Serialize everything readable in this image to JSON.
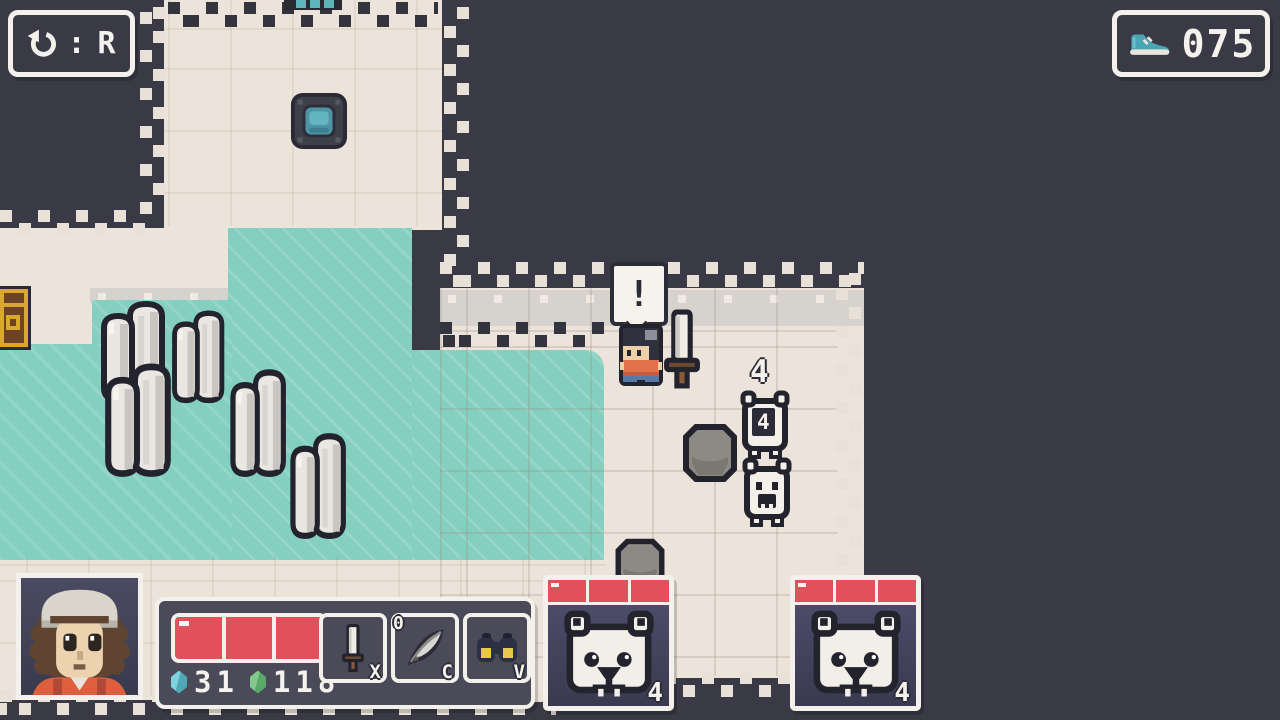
{
  "hud": {
    "undo_button": {
      "icon": "undo-arrow-icon",
      "separator": ":",
      "key": "R"
    },
    "step_counter": {
      "icon": "shoe-icon",
      "value": "075"
    }
  },
  "player": {
    "hp_segments": 3,
    "currencies": [
      {
        "icon": "teal-gem-icon",
        "value": "31",
        "color": "#4fa8b8"
      },
      {
        "icon": "green-gem-icon",
        "value": "118",
        "color": "#5ba968"
      }
    ],
    "slots": [
      {
        "icon": "sword-icon",
        "key": "X"
      },
      {
        "icon": "quill-icon",
        "key": "C",
        "count": "0"
      },
      {
        "icon": "binoculars-icon",
        "key": "V"
      }
    ]
  },
  "enemies": [
    {
      "name": "polar-bear",
      "hp_segments": 3,
      "hp_label": "4"
    },
    {
      "name": "polar-bear",
      "hp_segments": 3,
      "hp_label": "4"
    }
  ],
  "field": {
    "speech_bubble_text": "!",
    "bear_overhead_label": "4",
    "bear_body_label": "4"
  },
  "colors": {
    "background": "#3a3a47",
    "floor": "#ece4db",
    "water": "#84cfc0",
    "hp_red": "#e0515b",
    "ui_border": "#f4f1ec",
    "panel_bg": "#4a4a59"
  }
}
